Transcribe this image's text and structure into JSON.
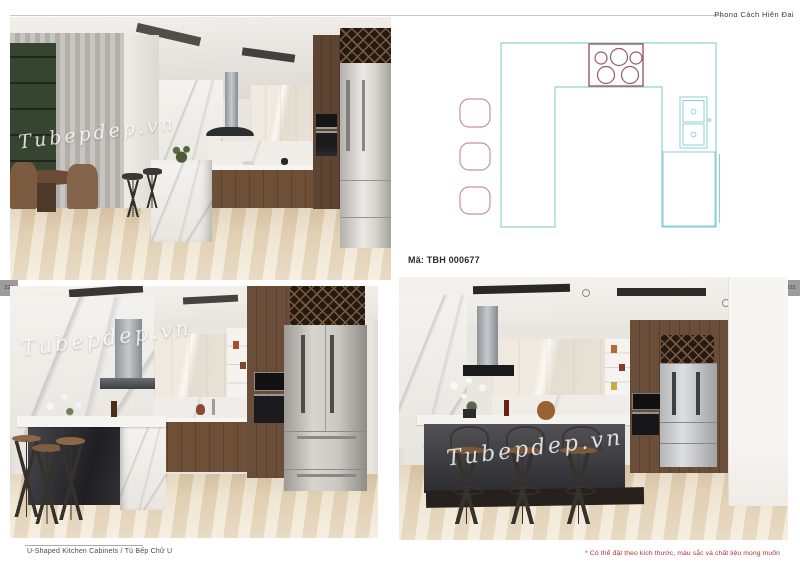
{
  "header": {
    "style_label": "Phong Cách Hiện Đại"
  },
  "page_tabs": {
    "left_number": "324",
    "right_number": "325",
    "tab_bg": "#9c9c9c"
  },
  "plan": {
    "code_label": "Mã: TBH 000677",
    "line_color": "#8fd0d4",
    "cooktop_color": "#9a5a62",
    "stool_color": "#c5929a",
    "elements": [
      "u-shaped-counter",
      "cooktop-5-burners",
      "double-sink",
      "refrigerator",
      "three-stools"
    ]
  },
  "photos": [
    {
      "name": "kitchen-render-top-left",
      "watermark": "Tubepdep.vn"
    },
    {
      "name": "kitchen-render-bottom-left",
      "watermark": "Tubepdep.vn"
    },
    {
      "name": "kitchen-render-bottom-right",
      "watermark": "Tubepdep.vn"
    }
  ],
  "footer": {
    "left_caption": "U-Shaped Kitchen Cabinets / Tủ Bếp Chữ U",
    "right_note": "* Có thể đặt theo kích thước, màu sắc và chất liệu mong muốn",
    "note_color": "#b23232"
  }
}
